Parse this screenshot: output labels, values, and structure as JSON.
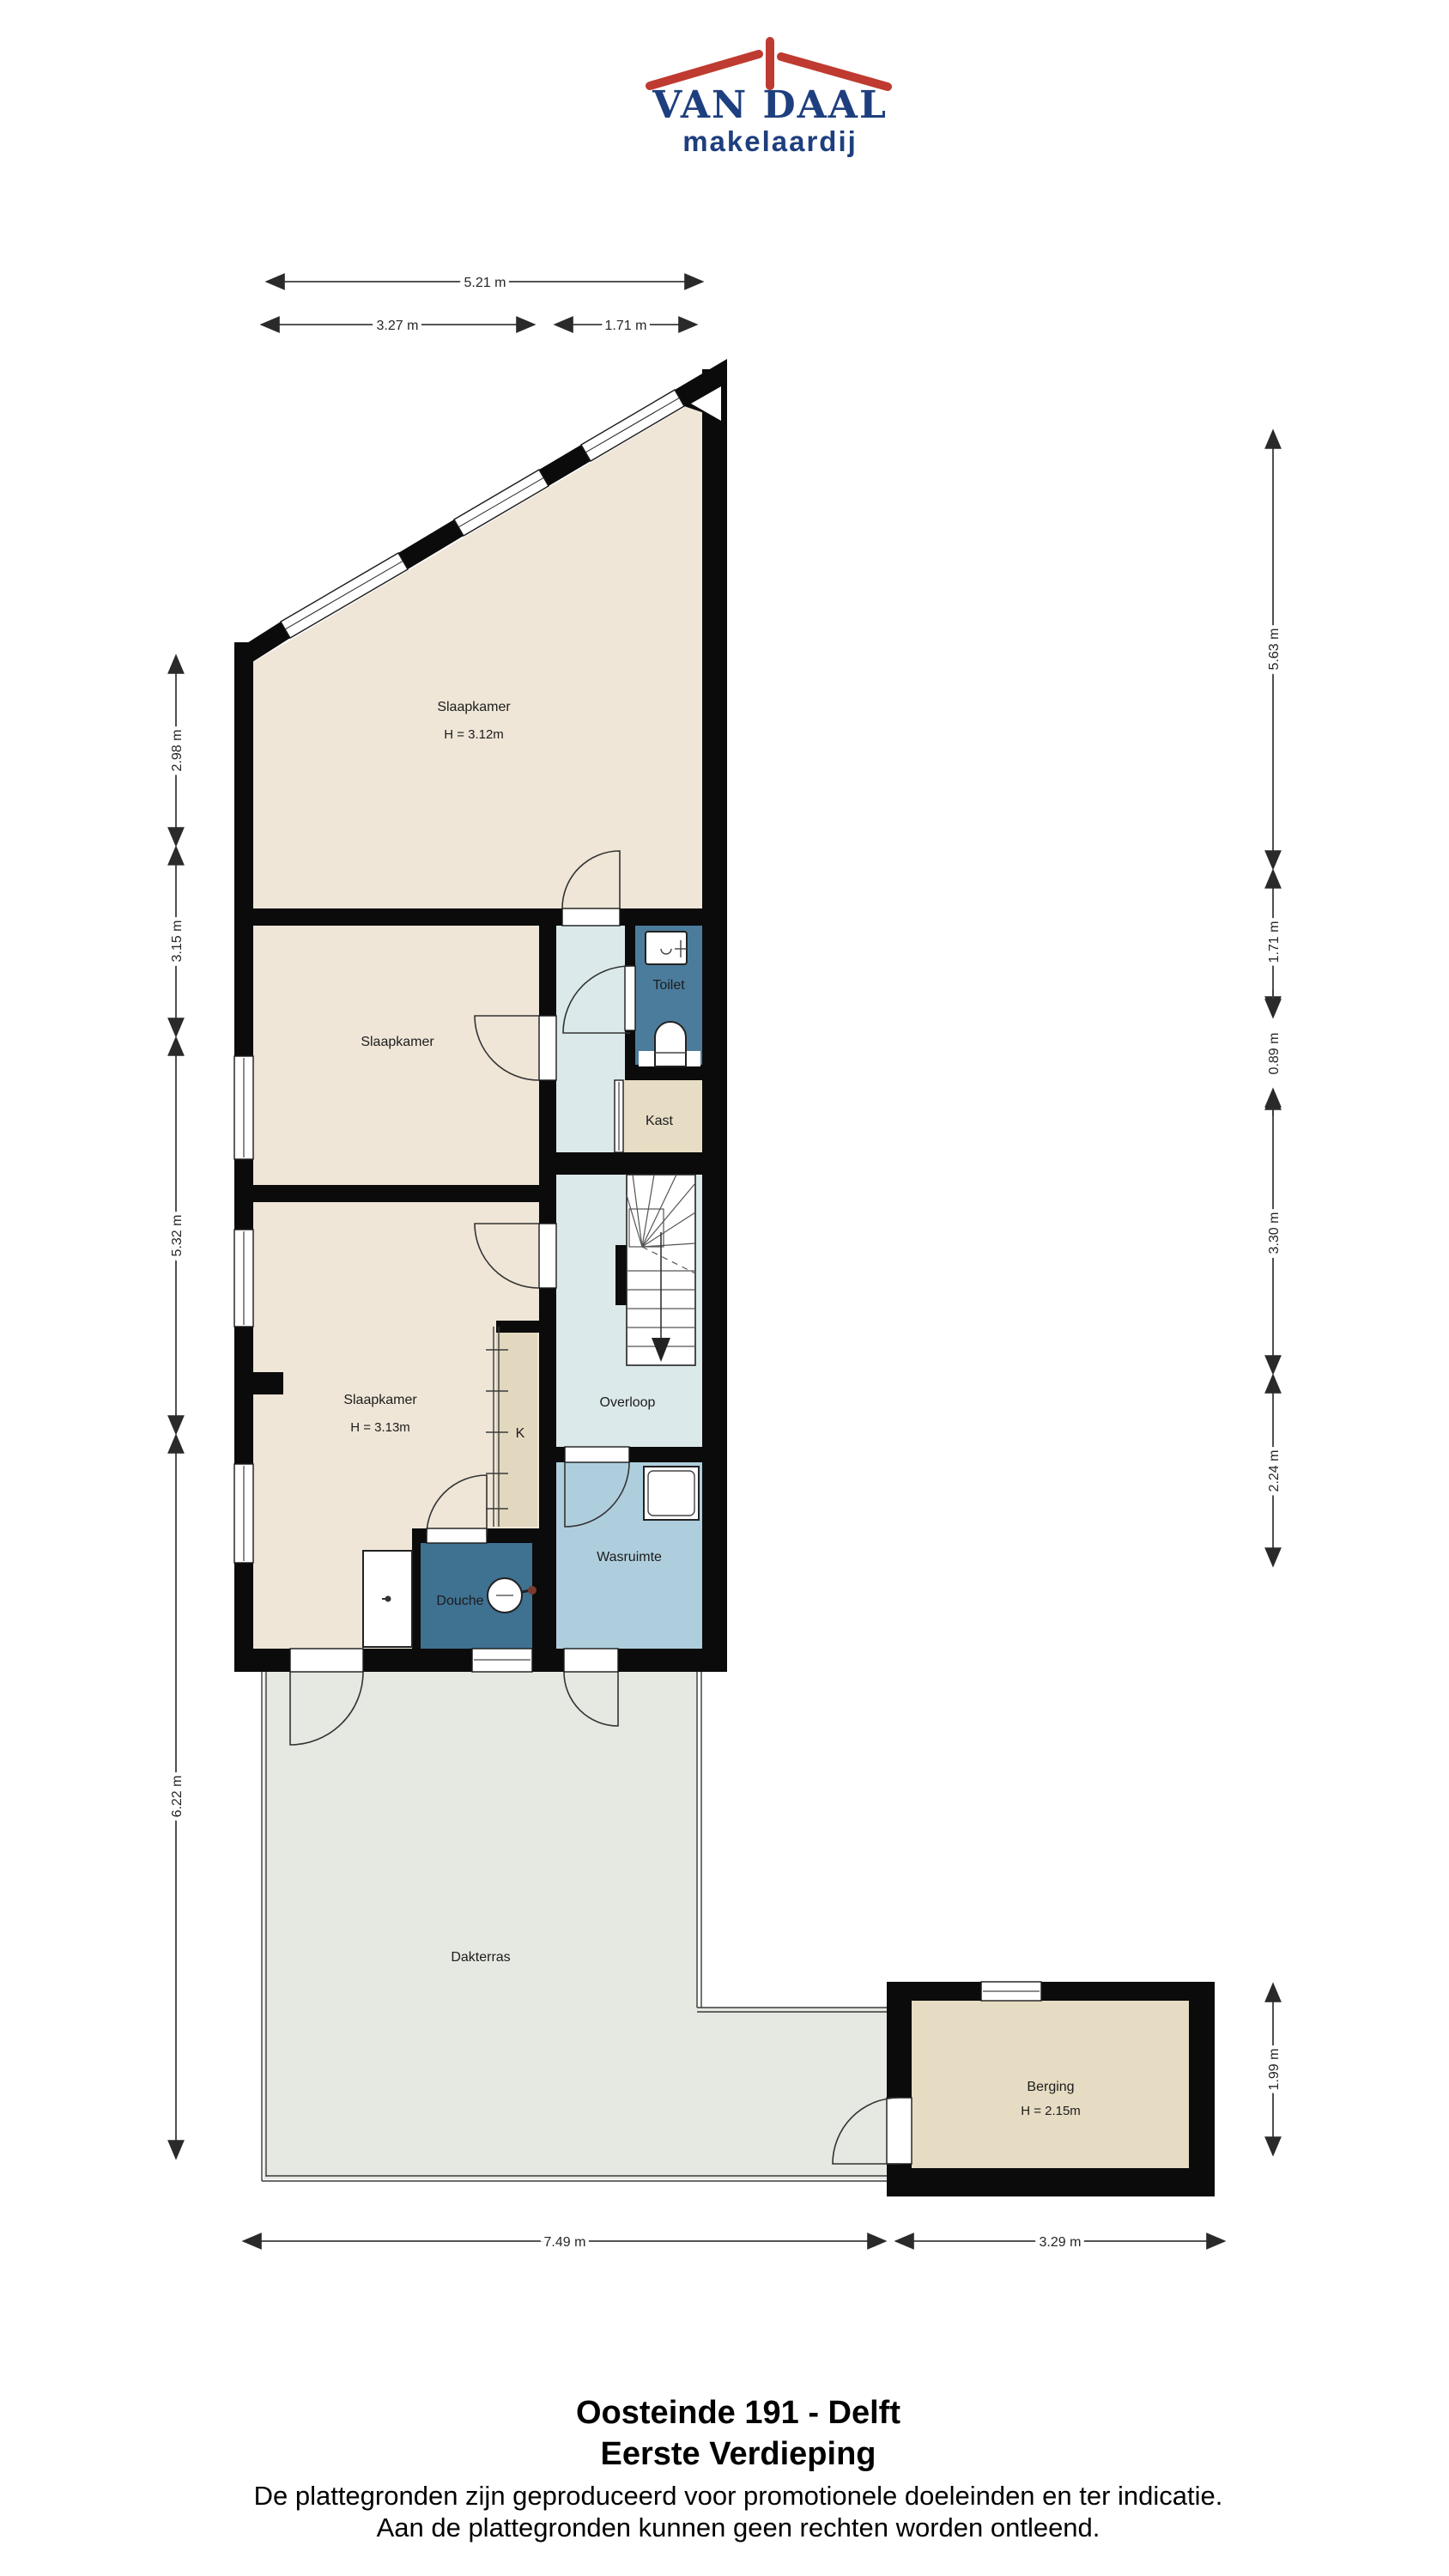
{
  "logo": {
    "name": "VAN DAAL",
    "tagline": "makelaardij"
  },
  "rooms": {
    "slaapkamer1": {
      "label": "Slaapkamer",
      "height": "H = 3.12m"
    },
    "slaapkamer2": {
      "label": "Slaapkamer"
    },
    "slaapkamer3": {
      "label": "Slaapkamer",
      "height": "H = 3.13m"
    },
    "toilet": {
      "label": "Toilet"
    },
    "kast": {
      "label": "Kast"
    },
    "kast_k": {
      "label": "K"
    },
    "overloop": {
      "label": "Overloop"
    },
    "wasruimte": {
      "label": "Wasruimte"
    },
    "douche": {
      "label": "Douche"
    },
    "dakterras": {
      "label": "Dakterras"
    },
    "berging": {
      "label": "Berging",
      "height": "H = 2.15m"
    }
  },
  "dimensions": {
    "top": [
      {
        "label": "5.21 m"
      },
      {
        "label": "3.27 m"
      },
      {
        "label": "1.71 m"
      }
    ],
    "left": [
      {
        "label": "2.98 m"
      },
      {
        "label": "3.15 m"
      },
      {
        "label": "5.32 m"
      },
      {
        "label": "6.22 m"
      }
    ],
    "right": [
      {
        "label": "5.63 m"
      },
      {
        "label": "1.71 m"
      },
      {
        "label": "0.89 m"
      },
      {
        "label": "3.30 m"
      },
      {
        "label": "2.24 m"
      },
      {
        "label": "1.99 m"
      }
    ],
    "bottom": [
      {
        "label": "7.49 m"
      },
      {
        "label": "3.29 m"
      }
    ]
  },
  "footer": {
    "title": "Oosteinde 191 - Delft",
    "subtitle": "Eerste Verdieping",
    "disclaimer1": "De plattegronden zijn geproduceerd voor promotionele doeleinden en ter indicatie.",
    "disclaimer2": "Aan de plattegronden kunnen geen rechten worden ontleend."
  },
  "colors": {
    "bedroom": "#efe6d7",
    "closet_tan": "#e7ddc5",
    "k_tan": "#e2d8bf",
    "berging_tan": "#e6dcc3",
    "toilet_blue": "#4c7c9b",
    "douche_blue": "#3f7191",
    "wasruimte_blue": "#afcedd",
    "hall_blue": "#dce9ea",
    "terrace_gray": "#e6e8e2",
    "logo_red": "#bf3a30",
    "logo_blue": "#1e3f7f"
  }
}
